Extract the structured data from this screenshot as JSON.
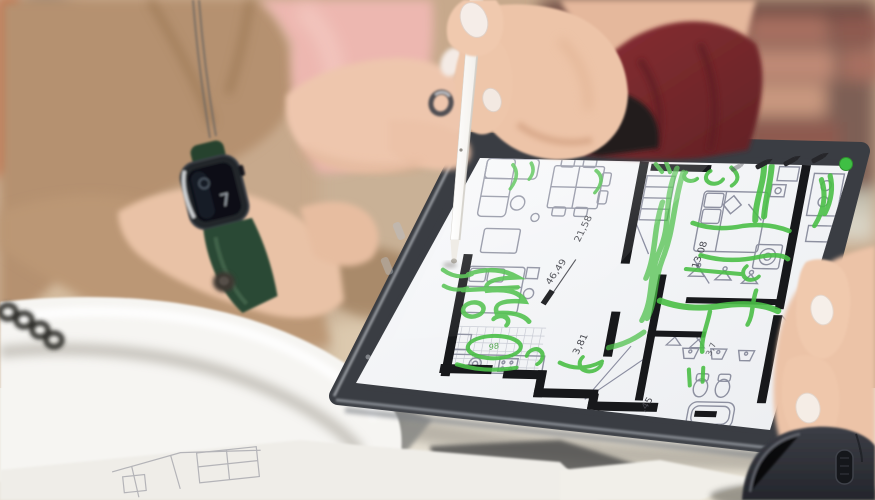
{
  "scene": {
    "description": "Two people at a desk reviewing an apartment floor plan on a tablet; a hand in a dark-red sleeve holds a white stylus over the screen, which is covered in green marker annotations. Blurred brick wall behind, papers and a computer mouse on the desk, smartwatch on the left wrist."
  },
  "tablet": {
    "toolbar": {
      "icons": [
        "pen-icon",
        "pen-icon",
        "pen-icon",
        "color-dot"
      ],
      "active_color": "#3fbf44"
    },
    "floor_plan": {
      "measurements": {
        "living": "21,58",
        "total_area": "46,49",
        "bedroom": "13,08",
        "hall": "3,81",
        "closet": "3,7",
        "bath": ",45"
      },
      "kitchen_note": "98",
      "annotation_color": "#4bbf47"
    }
  },
  "smartwatch": {
    "display_glyph": "7",
    "band_color": "#2c4a36"
  },
  "palette": {
    "bezel": "#3a3d43",
    "screen": "#f3f4f6",
    "brick": "#a8766a",
    "blazer": "#b5916f",
    "shirt": "#edb7b0",
    "sleeve": "#7e2b2e",
    "mouse": "#2f3136"
  }
}
